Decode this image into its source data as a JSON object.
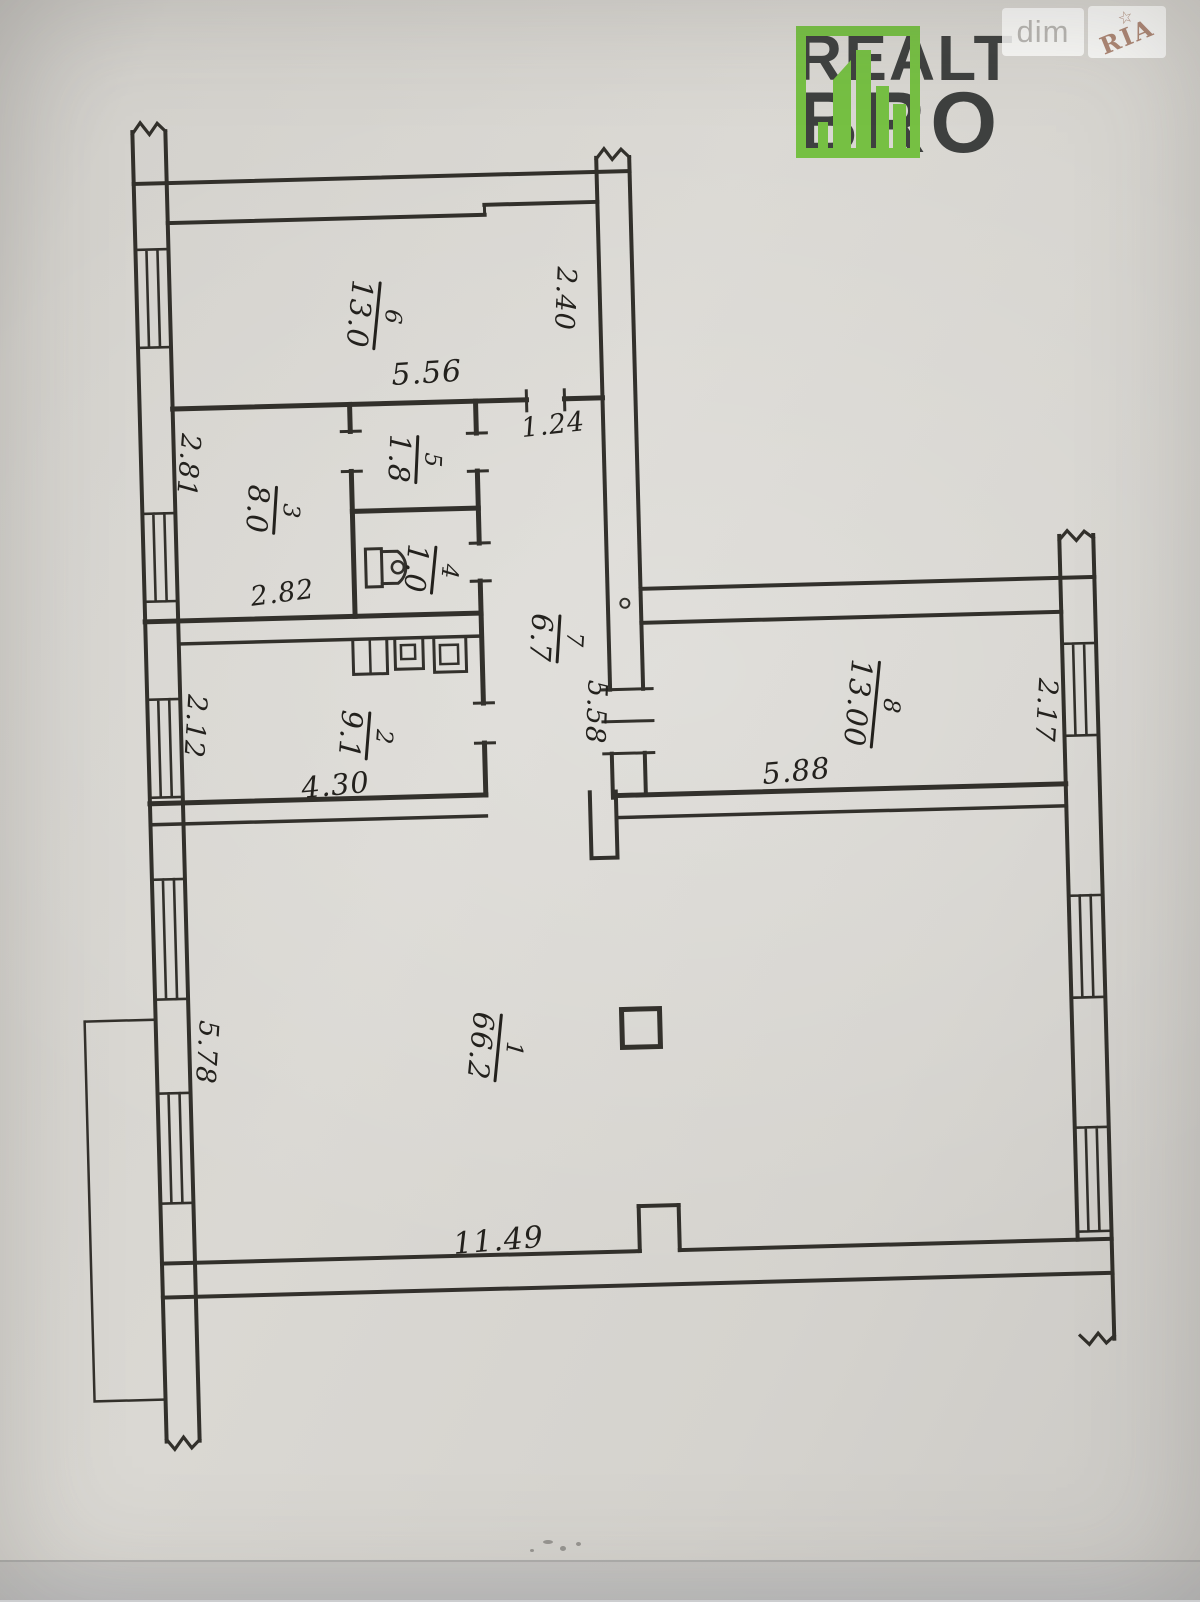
{
  "logo": {
    "line1": "REALT",
    "line2": "BRO",
    "accent_green": "#76c043",
    "text_color": "#3e403f"
  },
  "watermarks": {
    "dim_label": "dim",
    "ria_label": "RIA",
    "star_icon": "☆"
  },
  "plan": {
    "ink_color": "#26241f",
    "paper_color": "#d8d5d0",
    "rooms": [
      {
        "number": "1",
        "area": "66.2"
      },
      {
        "number": "2",
        "area": "9.1"
      },
      {
        "number": "3",
        "area": "8.0"
      },
      {
        "number": "4",
        "area": "1.0"
      },
      {
        "number": "5",
        "area": "1.8"
      },
      {
        "number": "6",
        "area": "13.0"
      },
      {
        "number": "7",
        "area": "6.7"
      },
      {
        "number": "8",
        "area": "13.00"
      }
    ],
    "dimensions": [
      {
        "value": "5.56"
      },
      {
        "value": "2.40"
      },
      {
        "value": "1.24"
      },
      {
        "value": "2.81"
      },
      {
        "value": "2.82"
      },
      {
        "value": "5.58"
      },
      {
        "value": "5.88"
      },
      {
        "value": "2.17"
      },
      {
        "value": "2.12"
      },
      {
        "value": "4.30"
      },
      {
        "value": "5.78"
      },
      {
        "value": "11.49"
      }
    ]
  }
}
